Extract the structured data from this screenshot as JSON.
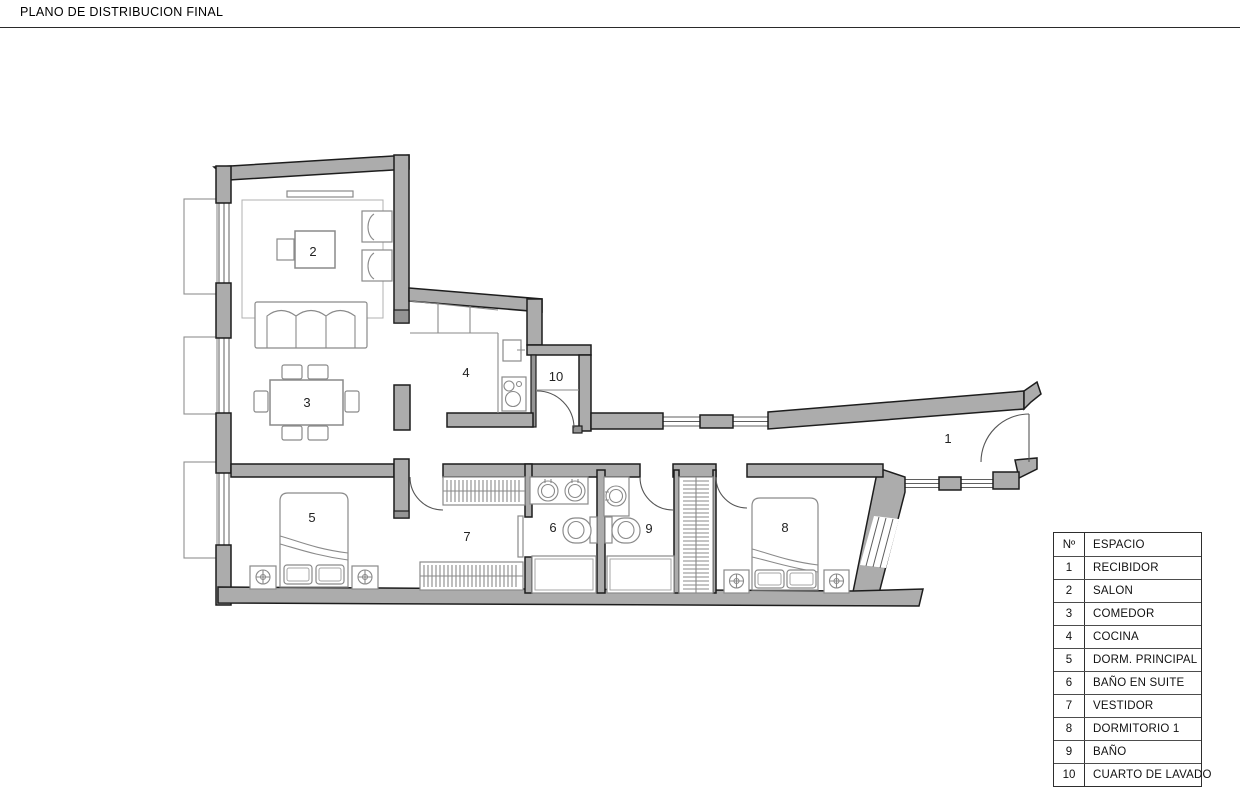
{
  "header": {
    "title": "PLANO DE DISTRIBUCION FINAL"
  },
  "legend": {
    "col_num": "Nº",
    "col_space": "ESPACIO"
  },
  "rooms": [
    {
      "number": "1",
      "name": "RECIBIDOR"
    },
    {
      "number": "2",
      "name": "SALON"
    },
    {
      "number": "3",
      "name": "COMEDOR"
    },
    {
      "number": "4",
      "name": "COCINA"
    },
    {
      "number": "5",
      "name": "DORM. PRINCIPAL"
    },
    {
      "number": "6",
      "name": "BAÑO EN SUITE"
    },
    {
      "number": "7",
      "name": "VESTIDOR"
    },
    {
      "number": "8",
      "name": "DORMITORIO 1"
    },
    {
      "number": "9",
      "name": "BAÑO"
    },
    {
      "number": "10",
      "name": "CUARTO DE LAVADO"
    }
  ],
  "colors": {
    "wall_fill": "#acacac",
    "wall_outline": "#1d1d1d",
    "furniture_line": "#8a8a8a",
    "background": "#ffffff"
  }
}
